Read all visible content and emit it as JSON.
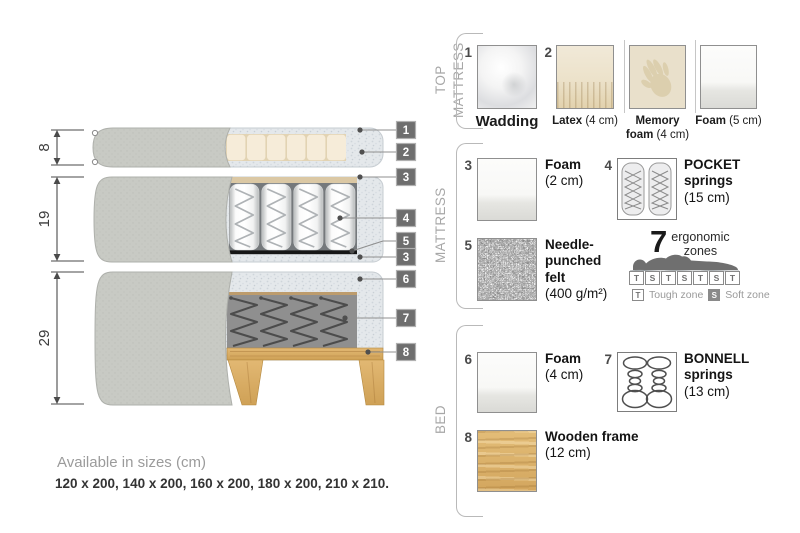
{
  "diagram": {
    "measurements": {
      "top_mattress": "8",
      "mattress": "19",
      "bed": "29"
    },
    "callouts": [
      "1",
      "2",
      "3",
      "4",
      "5",
      "3",
      "6",
      "7",
      "8"
    ]
  },
  "legend": {
    "sections": {
      "top_mattress": "TOP MATTRESS",
      "mattress": "MATTRESS",
      "bed": "BED"
    },
    "items": {
      "wadding": {
        "num": "1",
        "name": "Wadding",
        "detail": ""
      },
      "latex": {
        "num": "2",
        "name": "Latex",
        "detail": "(4 cm)"
      },
      "memory_foam": {
        "name": "Memory foam",
        "detail": "(4 cm)"
      },
      "foam_5": {
        "name": "Foam",
        "detail": "(5 cm)"
      },
      "foam_2": {
        "num": "3",
        "name": "Foam",
        "detail": "(2 cm)"
      },
      "pocket_springs": {
        "num": "4",
        "name": "POCKET springs",
        "detail": "(15 cm)"
      },
      "needle_felt": {
        "num": "5",
        "name": "Needle-punched felt",
        "detail": "(400 g/m²)"
      },
      "foam_4": {
        "num": "6",
        "name": "Foam",
        "detail": "(4 cm)"
      },
      "bonnell_springs": {
        "num": "7",
        "name": "BONNELL springs",
        "detail": "(13 cm)"
      },
      "wooden_frame": {
        "num": "8",
        "name": "Wooden frame",
        "detail": "(12 cm)"
      }
    },
    "ergonomic": {
      "number": "7",
      "line1": "ergonomic",
      "line2": "zones",
      "zones": [
        "T",
        "S",
        "T",
        "S",
        "T",
        "S",
        "T"
      ],
      "tough_key": "T",
      "tough_label": "Tough zone",
      "soft_key": "S",
      "soft_label": "Soft zone"
    }
  },
  "footer": {
    "sizes_title": "Available in sizes (cm)",
    "sizes_values": "120 x 200, 140 x 200, 160 x 200, 180 x 200, 210 x 210."
  },
  "colors": {
    "callout_chip": "#6e6e6e",
    "fabric_gray": "#c8cac4",
    "wadding_gray": "#e4e8eb",
    "latex_cream": "#f6ecd9",
    "wood": "#d9ae66",
    "felt_black": "#161616",
    "bonnell_gray": "#8f8f8f"
  }
}
